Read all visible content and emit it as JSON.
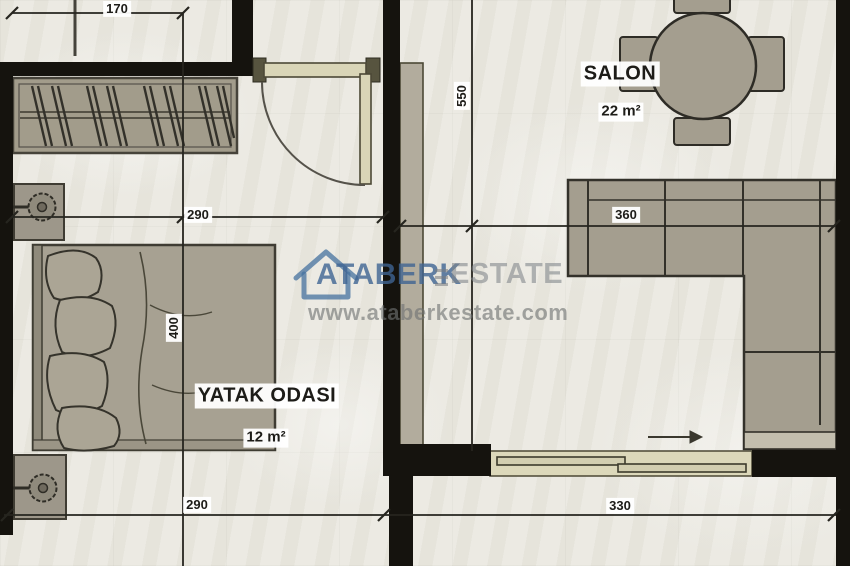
{
  "plan": {
    "rooms": {
      "bedroom": {
        "name": "YATAK ODASI",
        "area": "12 m²"
      },
      "salon": {
        "name": "SALON",
        "area": "22 m²"
      }
    },
    "dimensions": {
      "d170": "170",
      "d290_top": "290",
      "d290_bottom": "290",
      "d400": "400",
      "d550": "550",
      "d360": "360",
      "d330": "330"
    },
    "furniture_icons": [
      "wardrobe-icon",
      "double-bed-icon",
      "pillow-icon",
      "nightstand-lamp-icon",
      "round-dining-table-icon",
      "dining-chair-icon",
      "corner-sofa-icon",
      "hinged-door-icon",
      "sliding-door-icon",
      "direction-arrow-icon"
    ],
    "colors": {
      "wall": "#15130e",
      "furniture_fill": "#a49e8f",
      "furniture_outline": "#35332c",
      "door_panel": "#d9d5b7",
      "floor": "#e9e7df",
      "label_bg": "#ffffff",
      "label_text": "#1d1c18"
    }
  },
  "watermark": {
    "brand_primary": "ATABERK",
    "brand_secondary": "ESTATE",
    "website": "www.ataberkestate.com",
    "icon": "house-outline-icon",
    "primary_color": "#3e6492",
    "secondary_color": "#808589"
  }
}
